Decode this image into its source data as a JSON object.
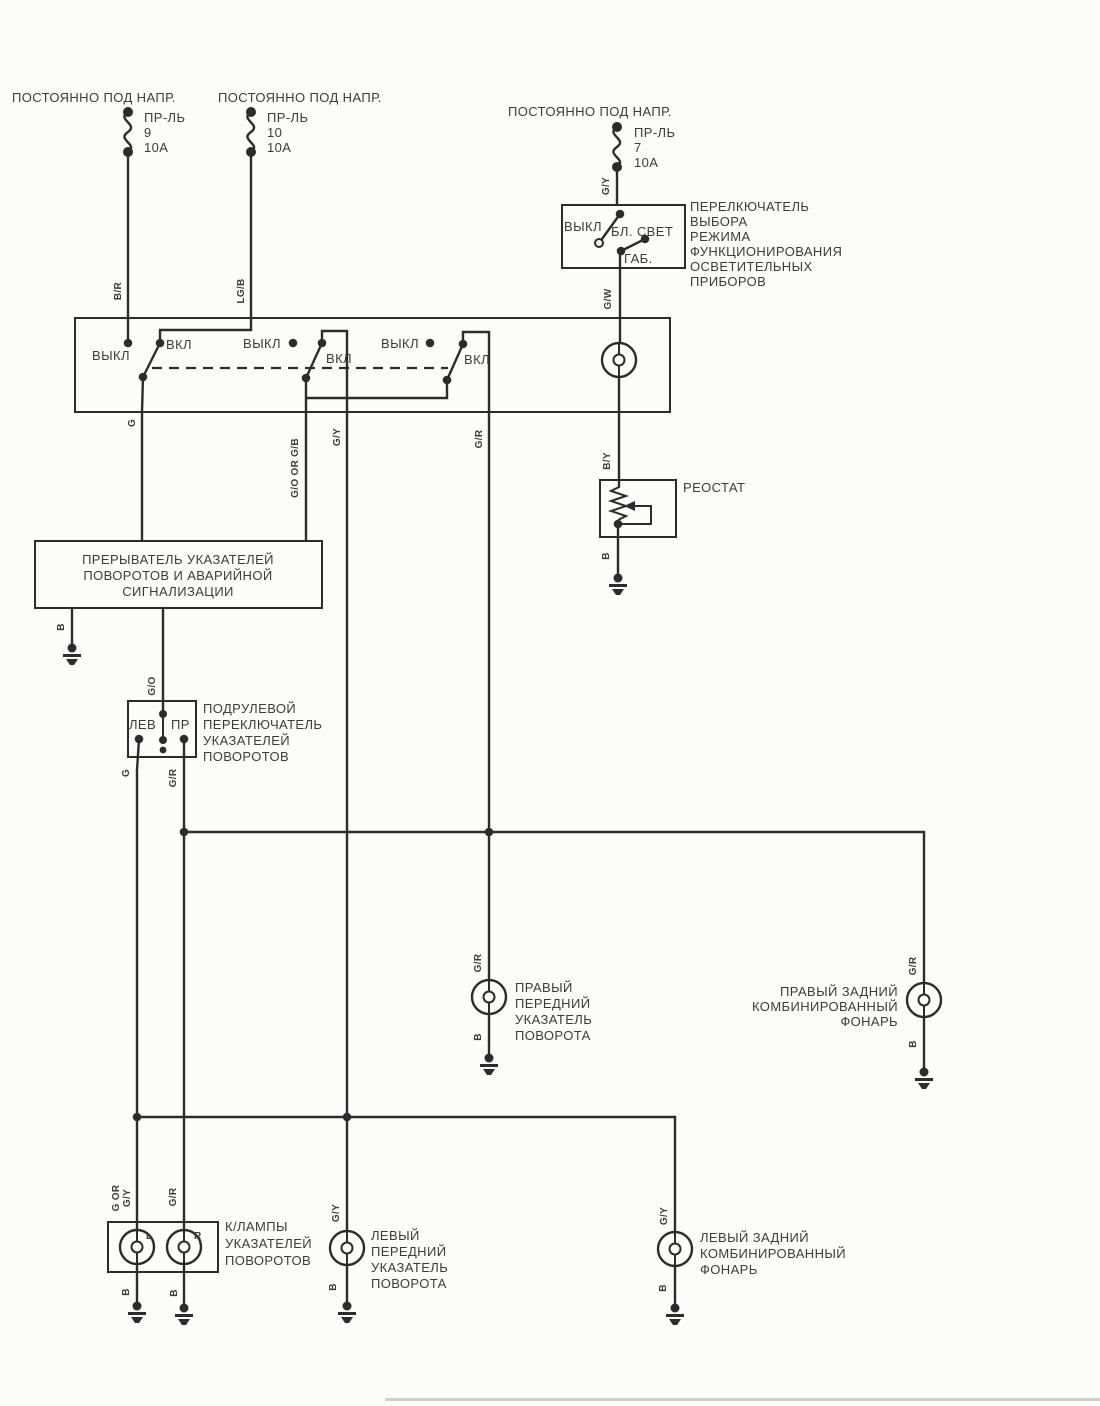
{
  "colors": {
    "ink": "#2c2c2c",
    "text": "#3b3b3b",
    "paper": "#fcfcfa"
  },
  "power_feeds": [
    {
      "label": "ПОСТОЯННО ПОД НАПР.",
      "fuse_name": "ПР-ЛЬ",
      "fuse_number": "9",
      "fuse_rating": "10А"
    },
    {
      "label": "ПОСТОЯННО ПОД НАПР.",
      "fuse_name": "ПР-ЛЬ",
      "fuse_number": "10",
      "fuse_rating": "10А"
    },
    {
      "label": "ПОСТОЯННО ПОД НАПР.",
      "fuse_name": "ПР-ЛЬ",
      "fuse_number": "7",
      "fuse_rating": "10А"
    }
  ],
  "mode_switch": {
    "pos_off": "ВЫКЛ",
    "pos_low": "БЛ. СВЕТ",
    "pos_park": "ГАБ.",
    "caption": [
      "ПЕРЕЛКЮЧАТЕЛЬ",
      "ВЫБОРА",
      "РЕЖИМА",
      "ФУНКЦИОНИРОВАНИЯ",
      "ОСВЕТИТЕЛЬНЫХ",
      "ПРИБОРОВ"
    ]
  },
  "hazard_block": {
    "s1_off": "ВЫКЛ",
    "s1_on": "ВКЛ",
    "s2_off": "ВЫКЛ",
    "s2_on": "ВКЛ",
    "s3_off": "ВЫКЛ",
    "s3_on": "ВКЛ"
  },
  "rheostat": {
    "caption": "РЕОСТАТ"
  },
  "flasher": {
    "caption": [
      "ПРЕРЫВАТЕЛЬ УКАЗАТЕЛЕЙ",
      "ПОВОРОТОВ И АВАРИЙНОЙ",
      "СИГНАЛИЗАЦИИ"
    ]
  },
  "stalk_switch": {
    "left": "ЛЕВ",
    "right": "ПР",
    "caption": [
      "ПОДРУЛЕВОЙ",
      "ПЕРЕКЛЮЧАТЕЛЬ",
      "УКАЗАТЕЛЕЙ",
      "ПОВОРОТОВ"
    ]
  },
  "right_front_lamp": {
    "caption": [
      "ПРАВЫЙ",
      "ПЕРЕДНИЙ",
      "УКАЗАТЕЛЬ",
      "ПОВОРОТА"
    ]
  },
  "right_rear_lamp": {
    "caption": [
      "ПРАВЫЙ ЗАДНИЙ",
      "КОМБИНИРОВАННЫЙ",
      "ФОНАРЬ"
    ]
  },
  "cluster_lamps": {
    "caption": [
      "К/ЛАМПЫ",
      "УКАЗАТЕЛЕЙ",
      "ПОВОРОТОВ"
    ],
    "lamp_left": "L",
    "lamp_right": "R"
  },
  "left_front_lamp": {
    "caption": [
      "ЛЕВЫЙ",
      "ПЕРЕДНИЙ",
      "УКАЗАТЕЛЬ",
      "ПОВОРОТА"
    ]
  },
  "left_rear_lamp": {
    "caption": [
      "ЛЕВЫЙ ЗАДНИЙ",
      "КОМБИНИРОВАННЫЙ",
      "ФОНАРЬ"
    ]
  },
  "wires": {
    "b_r": "B/R",
    "lg_b": "LG/B",
    "g_y_top": "G/Y",
    "g_w": "G/W",
    "b_y": "B/Y",
    "b_rheostat": "B",
    "g_main": "G",
    "g_o_or_g_b": "G/O OR G/B",
    "g_y_main": "G/Y",
    "g_r_main": "G/R",
    "b_flasher": "B",
    "g_o": "G/O",
    "g_stalk": "G",
    "g_r_stalk": "G/R",
    "g_r_rf": "G/R",
    "b_rf": "B",
    "g_r_rr": "G/R",
    "b_rr": "B",
    "g_or": "G OR",
    "g_y_cl": "G/Y",
    "g_r_cl": "G/R",
    "b_cl_l": "B",
    "b_cl_r": "B",
    "g_y_lf": "G/Y",
    "b_lf": "B",
    "g_y_lr": "G/Y",
    "b_lr": "B"
  }
}
